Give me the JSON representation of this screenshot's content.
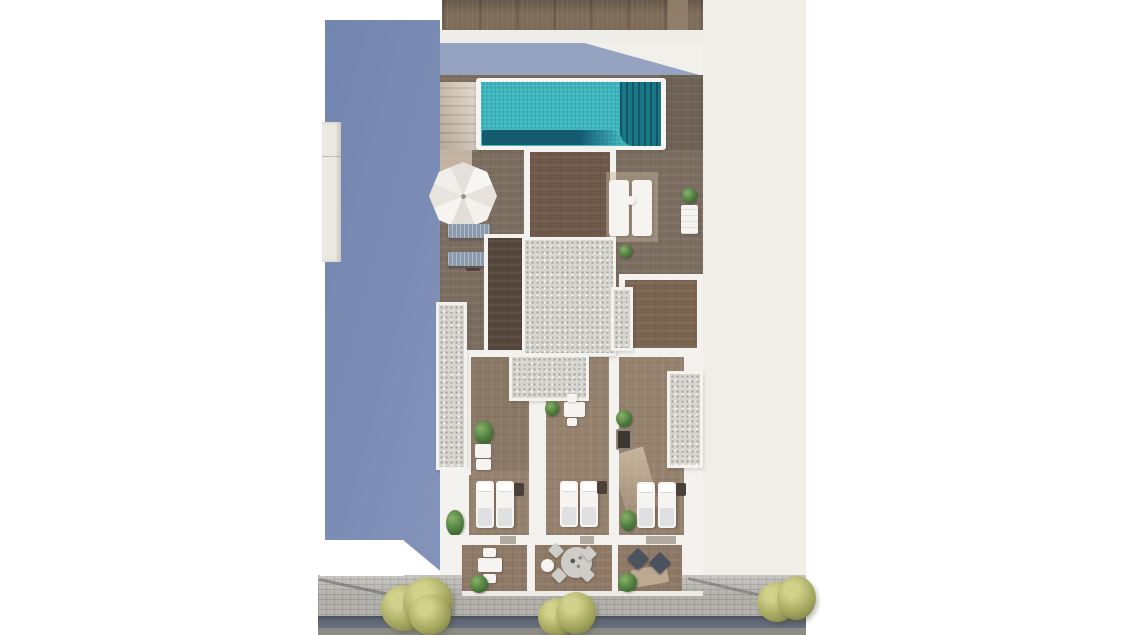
{
  "scene": {
    "kind": "aerial-3d-render",
    "description": "Top-down architectural render of a narrow residential building: rooftop pool with deck, parasol and loungers, gravel roof sections, three bedrooms with twin beds, three street-side terraces with outdoor furniture, neighbouring blue-grey rooftop on the left, sidewalk with trees and street at the bottom.",
    "width_px": 1130,
    "height_px": 635
  },
  "counts": {
    "bedrooms": 3,
    "beds": 6,
    "terraces": 3,
    "street_trees": 3,
    "gray_sun_loungers": 2,
    "white_sun_loungers": 2,
    "gravel_roof_sections": 5,
    "potted_plants": 9,
    "parasols": 1,
    "pools": 1
  },
  "features": [
    "neighbor-building",
    "rooftop-pool",
    "pool-deep-end",
    "pool-stairs",
    "parasol",
    "sun-deck",
    "gravel-roofs",
    "bedrooms-with-twin-beds",
    "nightstands",
    "street-terraces",
    "round-dining-set",
    "lounge-corner",
    "sidewalk",
    "street",
    "street-trees",
    "planters"
  ],
  "palette": {
    "page_bg": "#ffffff",
    "ambient_bg": "#f1eee7",
    "neighbor_blue_1": "#7285ae",
    "neighbor_blue_2": "#8493ba",
    "roof_structure": "#ece9e2",
    "top_roof": "#7d6c59",
    "top_roof_light": "#94836e",
    "band_white": "#efede8",
    "shade_bg": "#f2f0eb",
    "shade_blue": "#95a3c0",
    "wall_white": "#f3f2ee",
    "deck_wood": "#7b6d60",
    "deck_dark": "#6e6156",
    "pale_deck": "#c3b29a",
    "stairs_light": "#dccdba",
    "stairs_dark": "#c7b6a2",
    "pool_coping": "#f6f5f2",
    "pool_water": "#3ab5bd",
    "pool_deep": "#1b7687",
    "pool_shadow": "#0f4f63",
    "center_room_wood": "#6d5849",
    "dark_room_wood": "#55463c",
    "upper_room_wood": "#796450",
    "bedroom_wood": "#95826e",
    "terrace_wood": "#8d7965",
    "gravel": "#d7d5d0",
    "lounger_gray": "#8b99ad",
    "furniture_white": "#f5f4f1",
    "furniture_gray": "#cfcdc8",
    "furniture_dark": "#4b5260",
    "table_dark": "#3c3832",
    "nightstand": "#4a4038",
    "door_gap": "#b1aba1",
    "plant_green": "#4e7d3e",
    "plant_green_dark": "#35602c",
    "tree_base": "#a9aa62",
    "tree_light": "#d2d28c",
    "tree_dark": "#787b45",
    "pavement": "#b3b1ac",
    "street_dark": "#5c6370",
    "road_gray": "#8e8b86",
    "mat_beige": "#cbb9a2",
    "shadow_line": "#4a4f58"
  }
}
